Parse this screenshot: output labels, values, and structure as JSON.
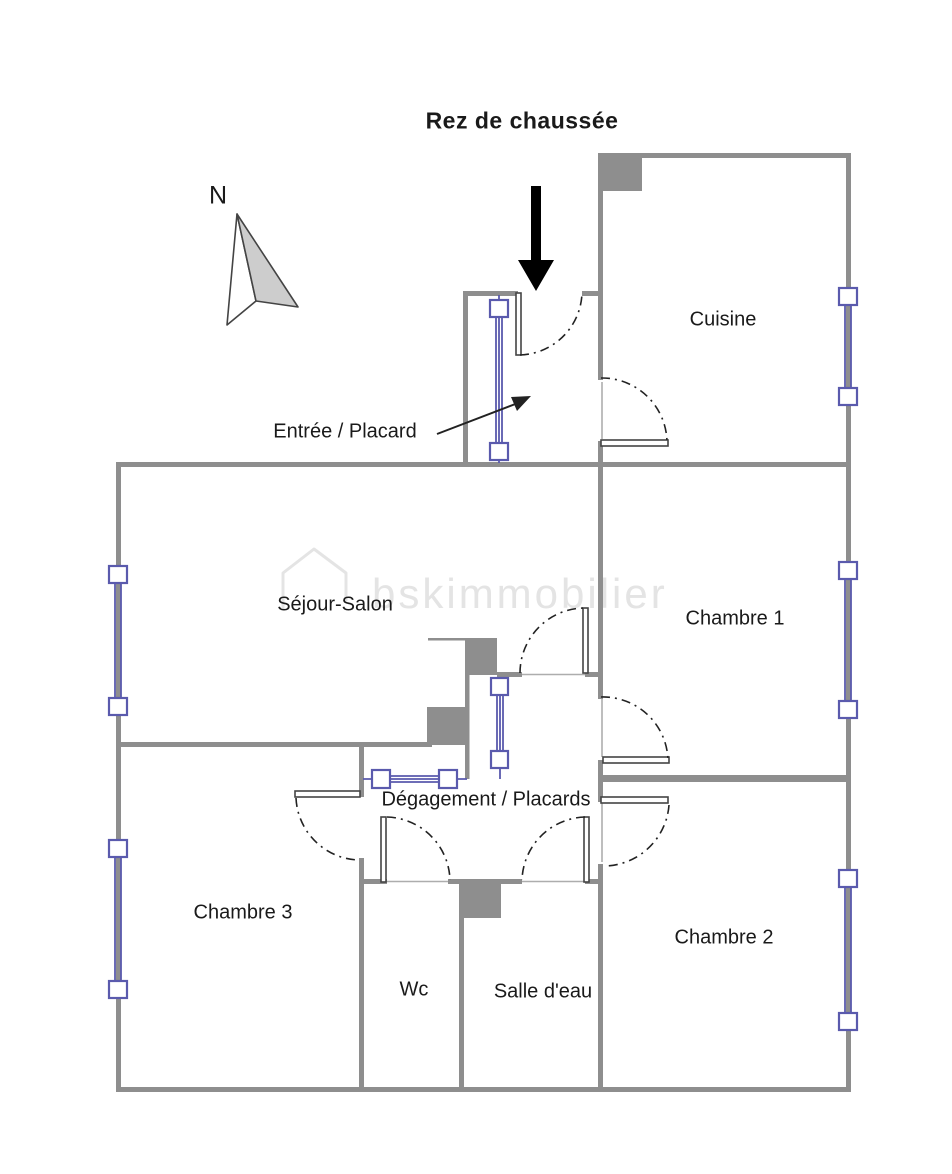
{
  "title": "Rez de chaussée",
  "compass": {
    "label": "N"
  },
  "watermark": {
    "text": "bskimmobilier"
  },
  "entry": {
    "label": "Entrée / Placard"
  },
  "rooms": {
    "cuisine": {
      "label": "Cuisine"
    },
    "chambre1": {
      "label": "Chambre 1"
    },
    "chambre2": {
      "label": "Chambre 2"
    },
    "chambre3": {
      "label": "Chambre 3"
    },
    "sejour": {
      "label": "Séjour-Salon"
    },
    "degagement": {
      "label": "Dégagement / Placards"
    },
    "wc": {
      "label": "Wc"
    },
    "salle_eau": {
      "label": "Salle d'eau"
    }
  },
  "colors": {
    "wall": "#8e8e8e",
    "window_blue": "#5a5aad",
    "watermark": "#e4e4e4",
    "door_line": "#444444",
    "arc": "#222222",
    "arrow": "#000000",
    "compass_fill": "#cdcdcd",
    "text": "#1a1a1a"
  }
}
